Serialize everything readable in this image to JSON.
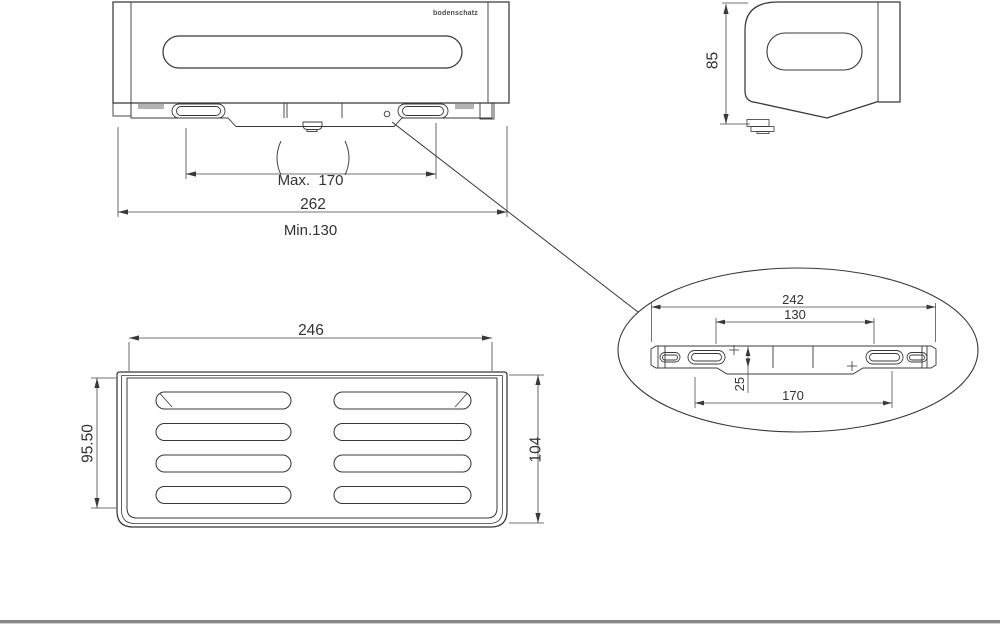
{
  "colors": {
    "background": "#ffffff",
    "line": "#383838",
    "dim_line": "#444444",
    "hatch": "#b3b3b3",
    "bottom_bar": "#868686"
  },
  "brand": {
    "logo": "bodenschatz"
  },
  "front_view": {
    "mount_max": "Max.  170",
    "mount_min": "Min.130",
    "overall_width": "262"
  },
  "side_view": {
    "overall_height": "85"
  },
  "top_view": {
    "opening_width": "246",
    "inner_depth": "95.50",
    "overall_depth": "104"
  },
  "detail_view": {
    "bracket_length": "242",
    "hole_spacing_min": "130",
    "bracket_height": "25",
    "hole_spacing_max": "170"
  }
}
